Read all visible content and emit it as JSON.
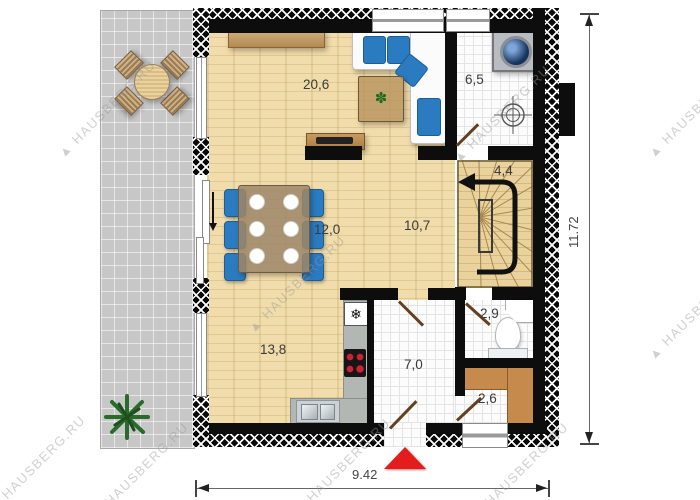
{
  "plan": {
    "rooms": {
      "living": "20,6",
      "utility": "6,5",
      "stairs": "4,4",
      "hall": "10,7",
      "dining": "12,0",
      "kitchen": "13,8",
      "entry": "7,0",
      "wc": "2,9",
      "pantry": "2,6"
    },
    "dims": {
      "horizontal": "9.42",
      "vertical": "11.72"
    },
    "watermark": {
      "full": "▲ HAUSBERG.RU"
    },
    "icons": {
      "fridge": "❄",
      "table_plant": "✽"
    },
    "colors": {
      "wood": "#f1dcab",
      "terrace": "#c7c7c7",
      "wall": "#0d0d0d",
      "accent_blue": "#2b7bc0",
      "marker_red": "#e41c1c",
      "shelf_brown": "#c68a4c",
      "counter_gray": "#b3b7b3"
    }
  }
}
